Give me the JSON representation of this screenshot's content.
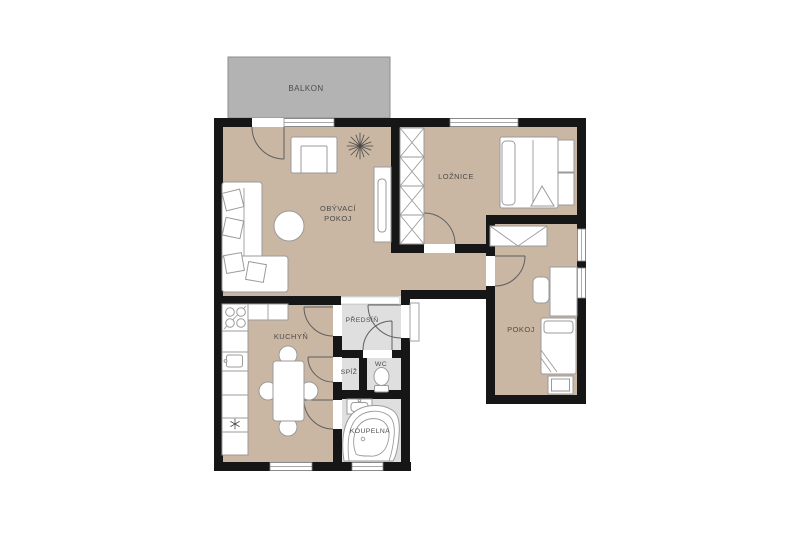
{
  "title": "Apartment floor plan",
  "labels": {
    "balcony": "BALKON",
    "living_room_line1": "OBÝVACÍ",
    "living_room_line2": "POKOJ",
    "bedroom": "LOŽNICE",
    "room": "POKOJ",
    "kitchen": "KUCHYŇ",
    "hallway": "PŘEDSÍŇ",
    "pantry": "SPÍŽ",
    "wc": "WC",
    "bathroom": "KOUPELNA"
  },
  "colors": {
    "wall": "#161616",
    "floor-room": "#c9b6a3",
    "floor-service": "#dfdfdf",
    "balcony": "#b3b3b3",
    "furn": "#9b9b9b",
    "door": "#5f5f5f",
    "label": "#4d4d4d",
    "bg": "#ffffff"
  }
}
